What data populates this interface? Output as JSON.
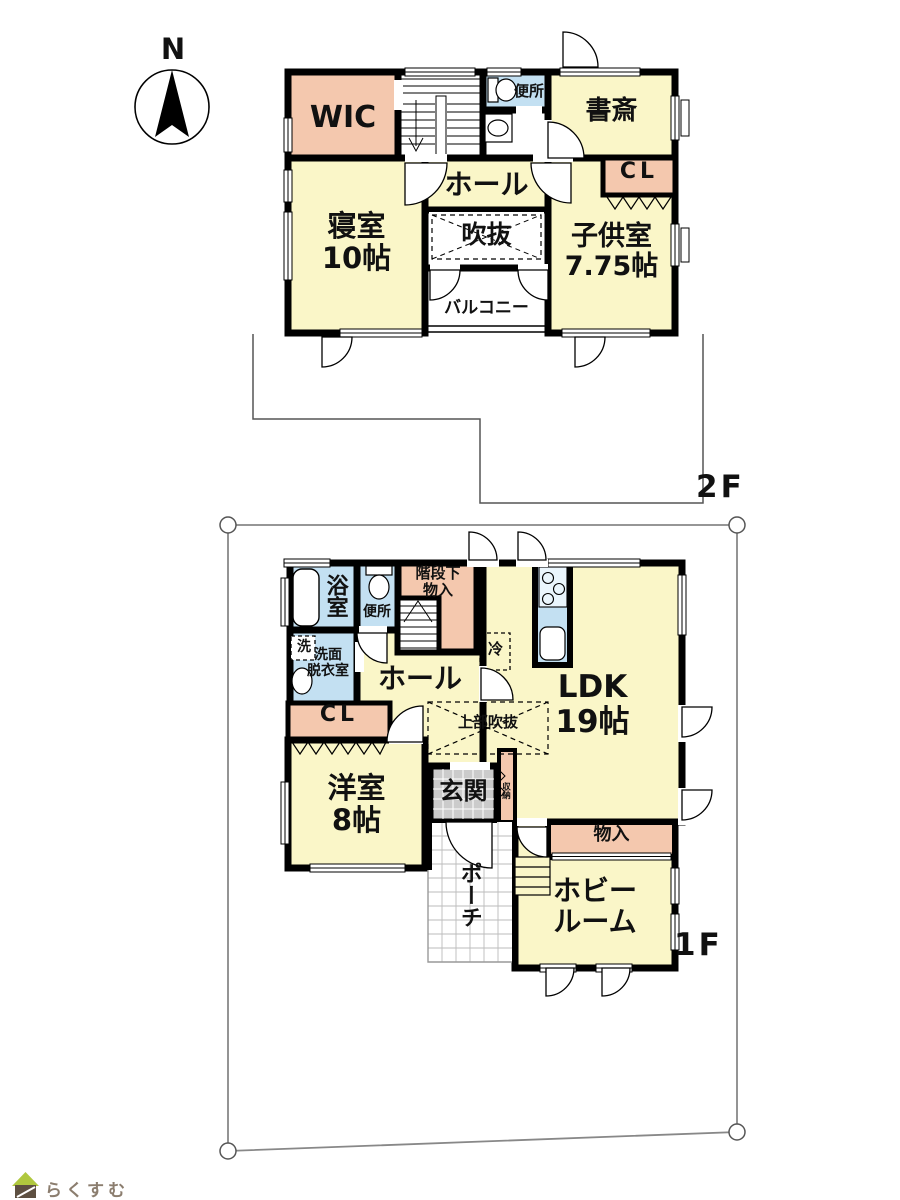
{
  "compass": {
    "north": "N"
  },
  "floor2": {
    "label": "2F",
    "wic": "WIC",
    "toilet": "便所",
    "study": "書斎",
    "hall": "ホール",
    "closet": "CL",
    "void": "吹抜",
    "bedroom": "寝室",
    "bedroom_size": "10帖",
    "kids_room": "子供室",
    "kids_size": "7.75帖",
    "balcony": "バルコニー"
  },
  "floor1": {
    "label": "1F",
    "bath": "浴室",
    "toilet": "便所",
    "stair_storage_line1": "階段下",
    "stair_storage_line2": "物入",
    "washer": "洗",
    "washroom_line1": "洗面",
    "washroom_line2": "脱衣室",
    "hall": "ホール",
    "fridge": "冷",
    "ldk": "LDK",
    "ldk_size": "19帖",
    "upper_void": "上部吹抜",
    "closet": "CL",
    "western_room": "洋室",
    "western_size": "8帖",
    "entrance": "玄関",
    "shoe_storage": "収納",
    "porch": "ポーチ",
    "storage": "物入",
    "hobby_line1": "ホビー",
    "hobby_line2": "ルーム"
  },
  "footer": {
    "logo": "らくすむ"
  },
  "colors": {
    "room_yellow": "#FAF6C8",
    "storage_pink": "#F4C8AE",
    "water_blue": "#C3E0F2",
    "entrance_gray": "#CBCBCB",
    "wall_black": "#000000"
  }
}
